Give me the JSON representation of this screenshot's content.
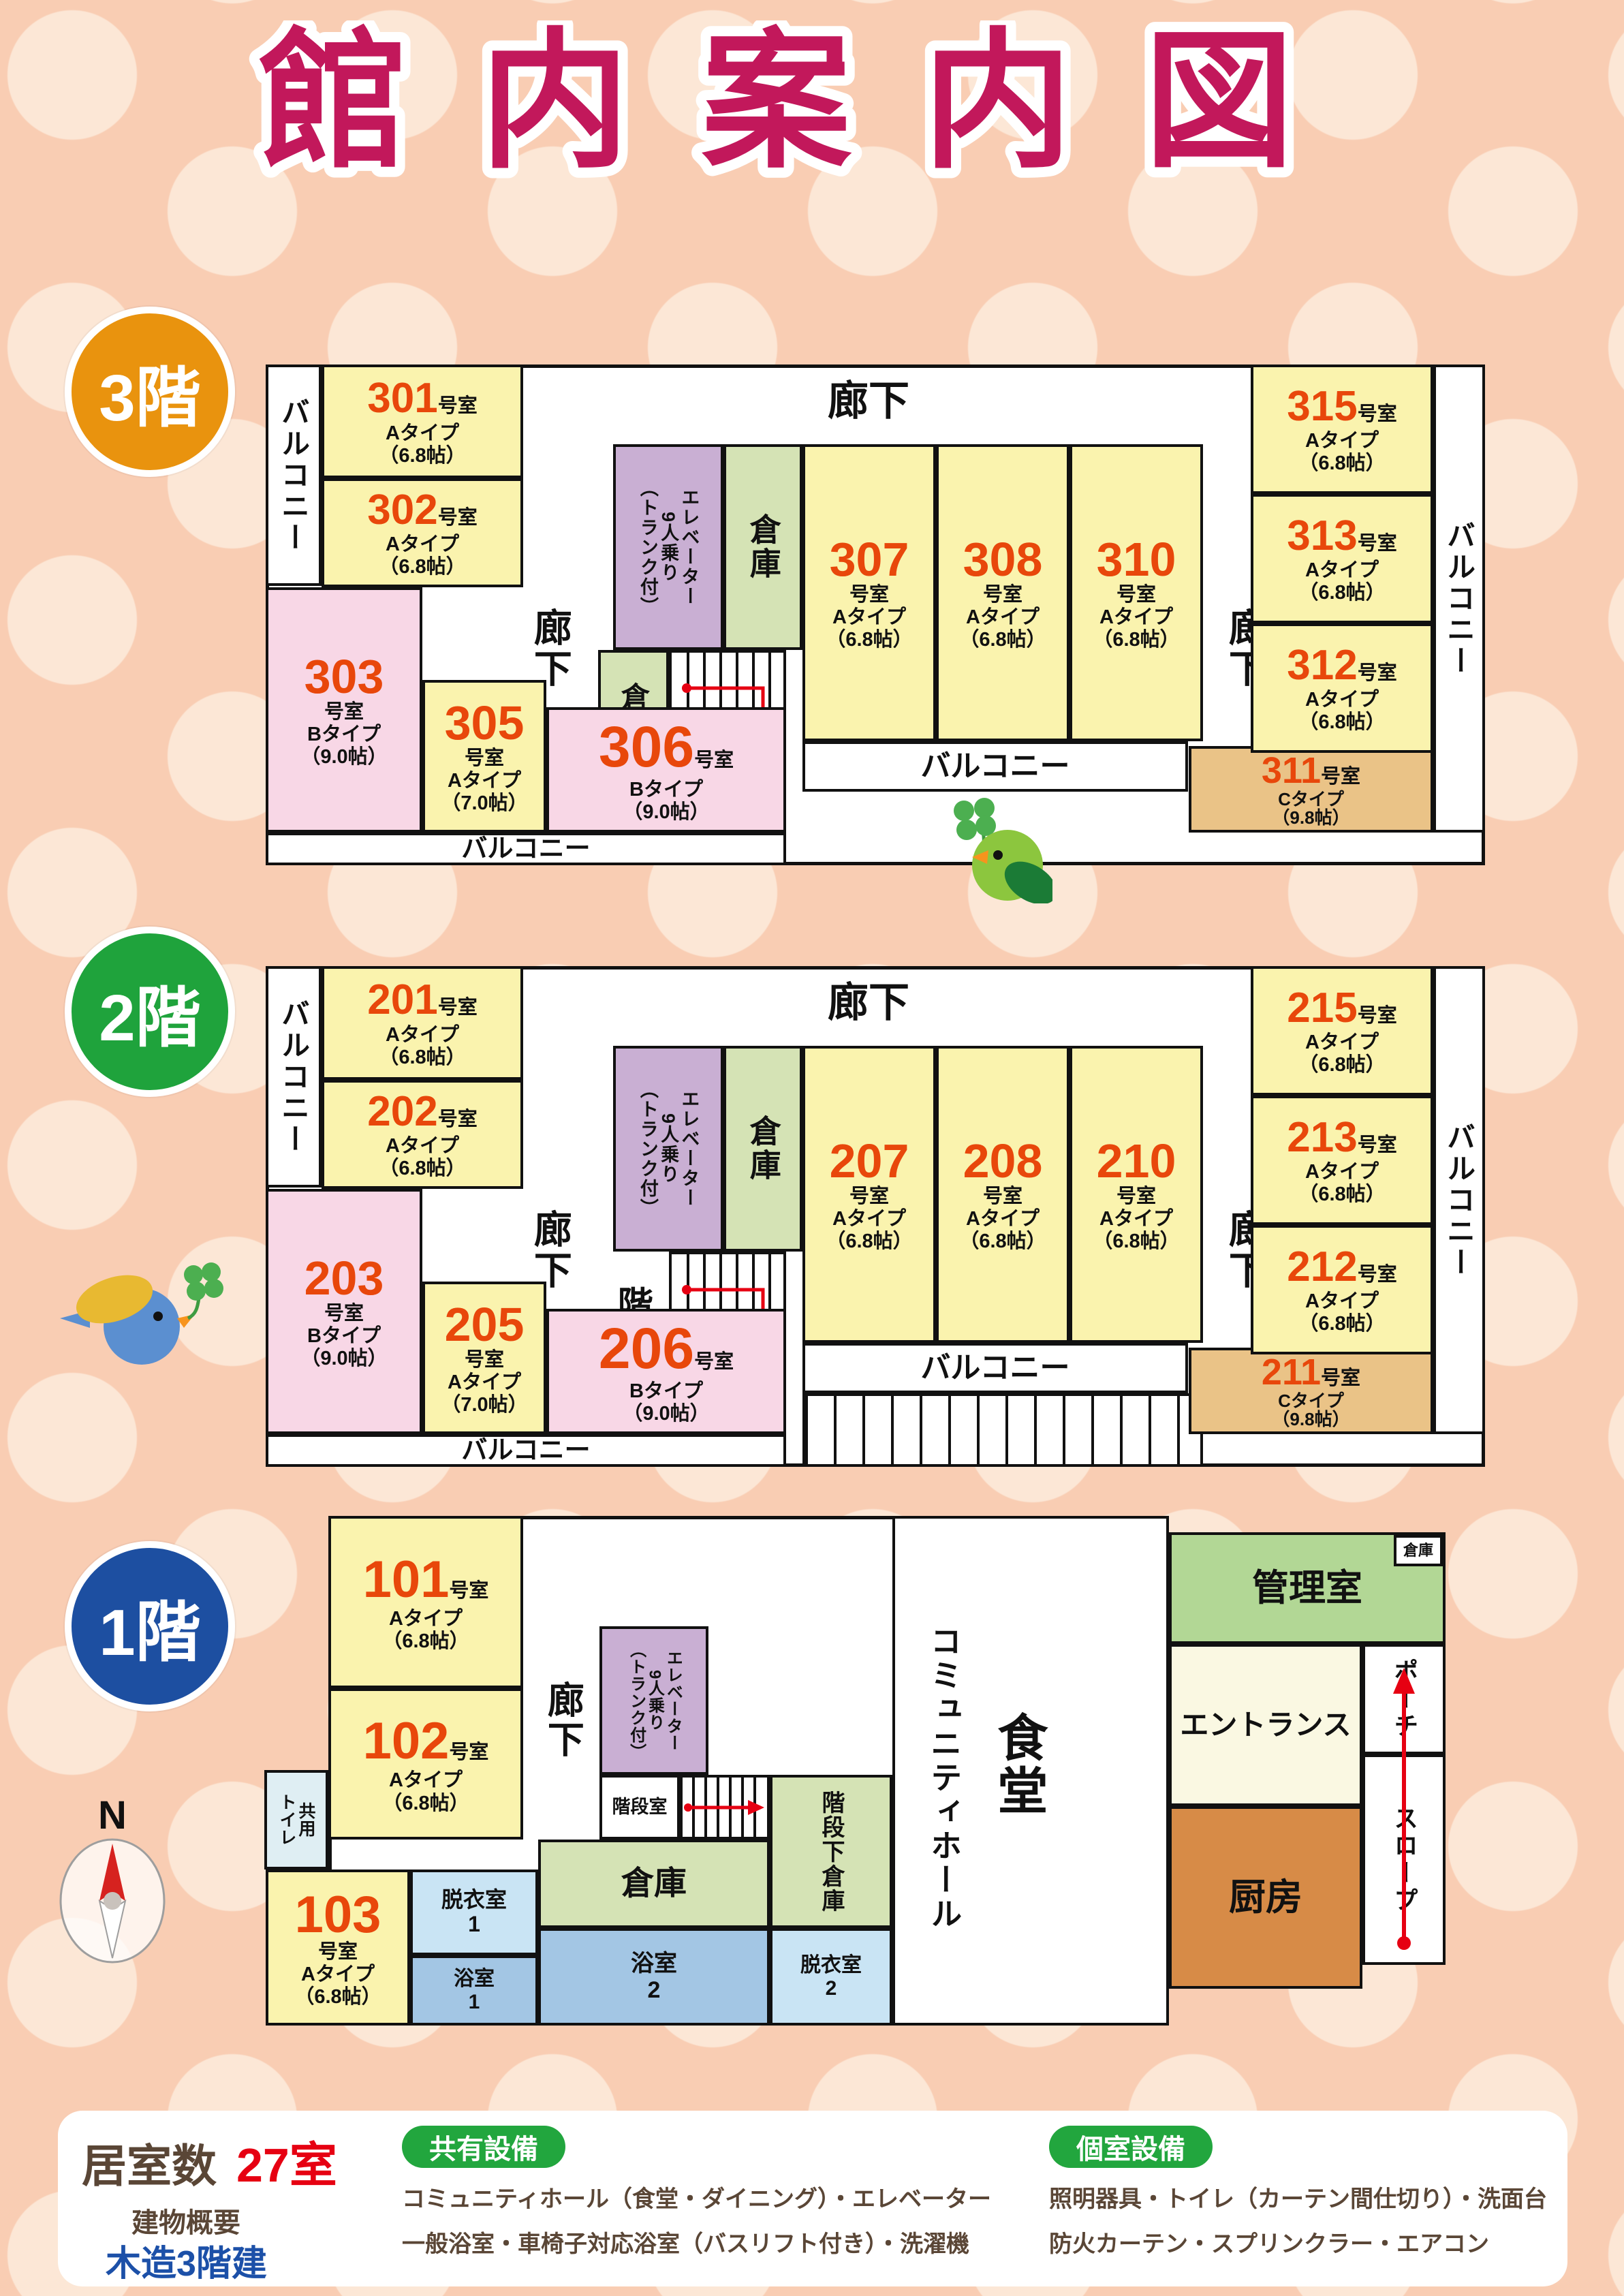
{
  "title": "館内案内図",
  "colors": {
    "title_magenta": "#C2185B",
    "room_number_orange": "#E8470B",
    "badge_3f_orange": "#E9930E",
    "badge_2f_green": "#1FA33C",
    "badge_1f_blue": "#1D4FA1",
    "room_type_a_yellow": "#FAF3AE",
    "room_type_b_pink": "#F8D7E6",
    "room_type_c_tan": "#EAC387",
    "elevator_purple": "#C9AFD3",
    "storage_green": "#D5E3B5",
    "management_green": "#B2D795",
    "entrance_cream": "#FAF8E2",
    "kitchen_brown": "#D78B47",
    "bath_blue": "#A3C6E4",
    "dressing_light_blue": "#C9E4F4",
    "toilet_cyan": "#DFEEF3",
    "legend_text_brown": "#5A4636",
    "legend_red": "#E60012",
    "legend_blue": "#1C50A8",
    "legend_badge_green": "#22A63E",
    "background_peach": "#F9CDB3",
    "arrow_red": "#E60012"
  },
  "floors": [
    {
      "badge": "3階",
      "rooms": [
        {
          "num": "301",
          "type": "Aタイプ",
          "size": "（6.8帖）"
        },
        {
          "num": "302",
          "type": "Aタイプ",
          "size": "（6.8帖）"
        },
        {
          "num": "303",
          "type": "Bタイプ",
          "size": "（9.0帖）"
        },
        {
          "num": "305",
          "type": "Aタイプ",
          "size": "（7.0帖）"
        },
        {
          "num": "306",
          "type": "Bタイプ",
          "size": "（9.0帖）"
        },
        {
          "num": "307",
          "type": "Aタイプ",
          "size": "（6.8帖）"
        },
        {
          "num": "308",
          "type": "Aタイプ",
          "size": "（6.8帖）"
        },
        {
          "num": "310",
          "type": "Aタイプ",
          "size": "（6.8帖）"
        },
        {
          "num": "311",
          "type": "Cタイプ",
          "size": "（9.8帖）"
        },
        {
          "num": "312",
          "type": "Aタイプ",
          "size": "（6.8帖）"
        },
        {
          "num": "313",
          "type": "Aタイプ",
          "size": "（6.8帖）"
        },
        {
          "num": "315",
          "type": "Aタイプ",
          "size": "（6.8帖）"
        }
      ]
    },
    {
      "badge": "2階",
      "rooms": [
        {
          "num": "201",
          "type": "Aタイプ",
          "size": "（6.8帖）"
        },
        {
          "num": "202",
          "type": "Aタイプ",
          "size": "（6.8帖）"
        },
        {
          "num": "203",
          "type": "Bタイプ",
          "size": "（9.0帖）"
        },
        {
          "num": "205",
          "type": "Aタイプ",
          "size": "（7.0帖）"
        },
        {
          "num": "206",
          "type": "Bタイプ",
          "size": "（9.0帖）"
        },
        {
          "num": "207",
          "type": "Aタイプ",
          "size": "（6.8帖）"
        },
        {
          "num": "208",
          "type": "Aタイプ",
          "size": "（6.8帖）"
        },
        {
          "num": "210",
          "type": "Aタイプ",
          "size": "（6.8帖）"
        },
        {
          "num": "211",
          "type": "Cタイプ",
          "size": "（9.8帖）"
        },
        {
          "num": "212",
          "type": "Aタイプ",
          "size": "（6.8帖）"
        },
        {
          "num": "213",
          "type": "Aタイプ",
          "size": "（6.8帖）"
        },
        {
          "num": "215",
          "type": "Aタイプ",
          "size": "（6.8帖）"
        }
      ]
    },
    {
      "badge": "1階",
      "rooms": [
        {
          "num": "101",
          "type": "Aタイプ",
          "size": "（6.8帖）"
        },
        {
          "num": "102",
          "type": "Aタイプ",
          "size": "（6.8帖）"
        },
        {
          "num": "103",
          "type": "Aタイプ",
          "size": "（6.8帖）"
        }
      ]
    }
  ],
  "labels": {
    "corridor": "廊下",
    "balcony": "バルコニー",
    "storage": "倉庫",
    "stair_room": "階段室",
    "elevator": "エレベーター\n9人乗り\n（トランク付）",
    "under_stair_storage": "階段下倉庫",
    "shared_toilet": "共用\nトイレ",
    "dressing_room_1": "脱衣室\n1",
    "bath_1": "浴室\n1",
    "bath_2": "浴室\n2",
    "dressing_room_2": "脱衣室\n2",
    "dining": "食堂",
    "community_hall": "コミュニティホール",
    "management_room": "管理室",
    "entrance": "エントランス",
    "porch": "ポーチ",
    "slope": "スロープ",
    "kitchen": "厨房",
    "room_suffix": "号室",
    "compass_n": "N"
  },
  "legend": {
    "rooms_label": "居室数",
    "rooms_value": "27室",
    "building_label": "建物概要",
    "building_value": "木造3階建",
    "shared_title": "共有設備",
    "shared_line1": "コミュニティホール（食堂・ダイニング）・エレベーター",
    "shared_line2": "一般浴室・車椅子対応浴室（バスリフト付き）・洗濯機",
    "private_title": "個室設備",
    "private_line1": "照明器具・トイレ（カーテン間仕切り）・洗面台",
    "private_line2": "防火カーテン・スプリンクラー・エアコン"
  }
}
